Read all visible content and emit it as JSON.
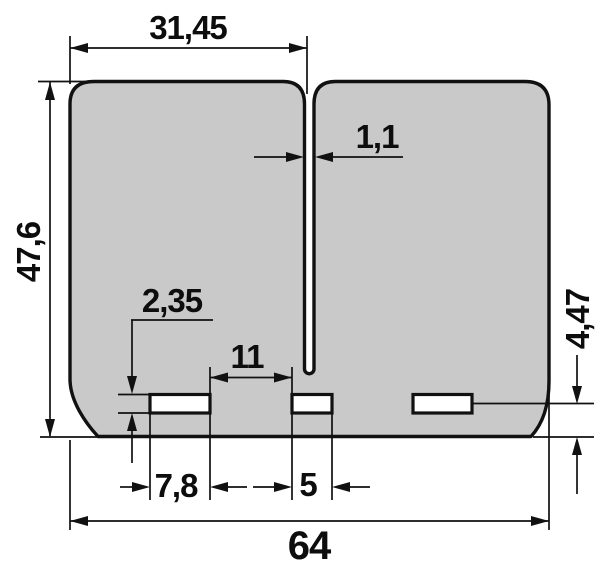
{
  "colors": {
    "background": "#ffffff",
    "part_fill": "#c9c9c9",
    "line": "#111111"
  },
  "drawing": {
    "dimensions": {
      "width_left_to_slit": "31,45",
      "slit_width": "1,1",
      "total_height": "47,6",
      "slot_height": "2,35",
      "slot_spacing": "11",
      "left_slot_width": "7,8",
      "center_slot_width": "5",
      "total_width": "64",
      "slot_line_to_bottom": "4,47"
    }
  }
}
